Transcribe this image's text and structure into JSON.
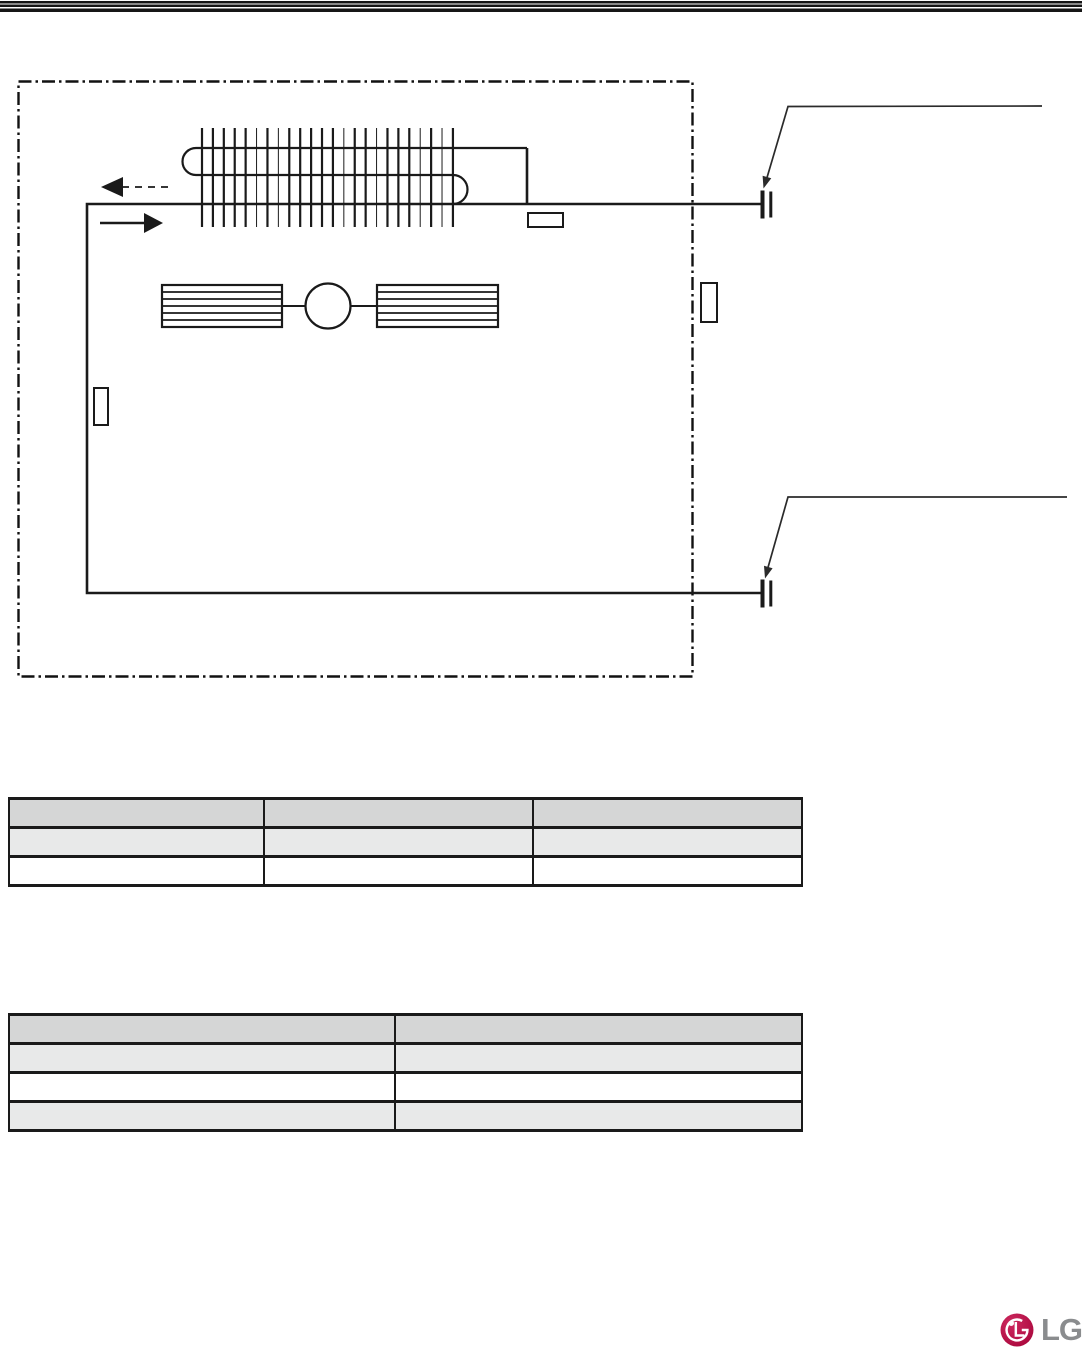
{
  "page": {
    "background": "#ffffff",
    "header_rule_color": "#161616"
  },
  "diagram": {
    "kind": "refrigerant-piping-cycle-diagram",
    "line_color": "#1a1a1a",
    "callout_line_color": "#2b2b2b",
    "boundary_style": "dash-dot",
    "components": [
      "indoor-unit-boundary",
      "finned-heat-exchanger-coil",
      "cross-flow-fan-with-motor",
      "pipe-sensor",
      "boundary-sensor",
      "liquid-line-sensor",
      "gas-pipe-flare-connection",
      "liquid-pipe-flare-connection",
      "airflow-arrow-dashed-left",
      "airflow-arrow-solid-right",
      "gas-pipe-callout-leader",
      "liquid-pipe-callout-leader"
    ]
  },
  "tables": {
    "t1": {
      "row_colors": [
        "#d5d6d6",
        "#e8e9e9",
        "#ffffff"
      ],
      "rows": [
        [
          "",
          "",
          ""
        ],
        [
          "",
          "",
          ""
        ],
        [
          "",
          "",
          ""
        ]
      ]
    },
    "t2": {
      "row_colors": [
        "#d5d6d6",
        "#e8e9e9",
        "#ffffff",
        "#e8e9e9"
      ],
      "rows": [
        [
          "",
          ""
        ],
        [
          "",
          ""
        ],
        [
          "",
          ""
        ],
        [
          "",
          ""
        ]
      ]
    }
  },
  "logo": {
    "text": "LG",
    "symbol_color": "#b01044",
    "symbol_highlight": "#ce2a60",
    "text_color": "#8a8c8e"
  }
}
